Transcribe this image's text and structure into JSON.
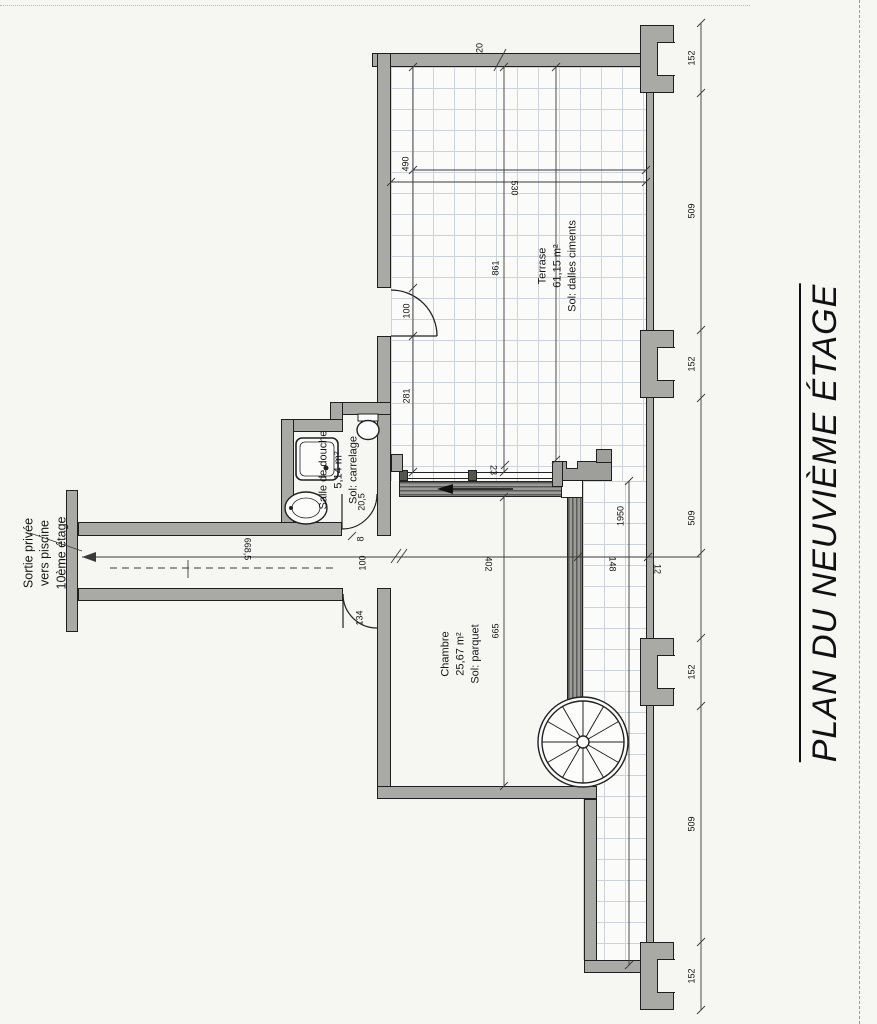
{
  "title": {
    "text": "PLAN DU NEUVIÈME ÉTAGE"
  },
  "exit_note": {
    "line1": "Sortie privée",
    "line2": "vers piscine",
    "line3": "10ème étage"
  },
  "rooms": {
    "terrace": {
      "name": "Terrase",
      "area": "61,15 m²",
      "floor": "Sol: dalles ciments"
    },
    "shower_room": {
      "name": "Salle de douche",
      "area": "5,14 m²",
      "floor": "Sol: carrelage"
    },
    "bedroom": {
      "name": "Chambre",
      "area": "25,67 m²",
      "floor": "Sol: parquet"
    }
  },
  "dimensions": {
    "wall_top": "20",
    "terrace_width_inner": "490",
    "terrace_width": "530",
    "terrace_depth": "861",
    "terrace_door": "100",
    "wall_seg": "281",
    "track": "23",
    "corridor": "668,5",
    "bedroom_width": "402",
    "strip_width": "148",
    "wall_thick": "12",
    "strip_length": "1950",
    "bedroom_depth": "665",
    "shower_door": "20,5",
    "gap": "8",
    "bedroom_door": "100",
    "door_clear": "134",
    "facade": [
      "152",
      "509",
      "152",
      "509",
      "152",
      "509",
      "152"
    ]
  }
}
